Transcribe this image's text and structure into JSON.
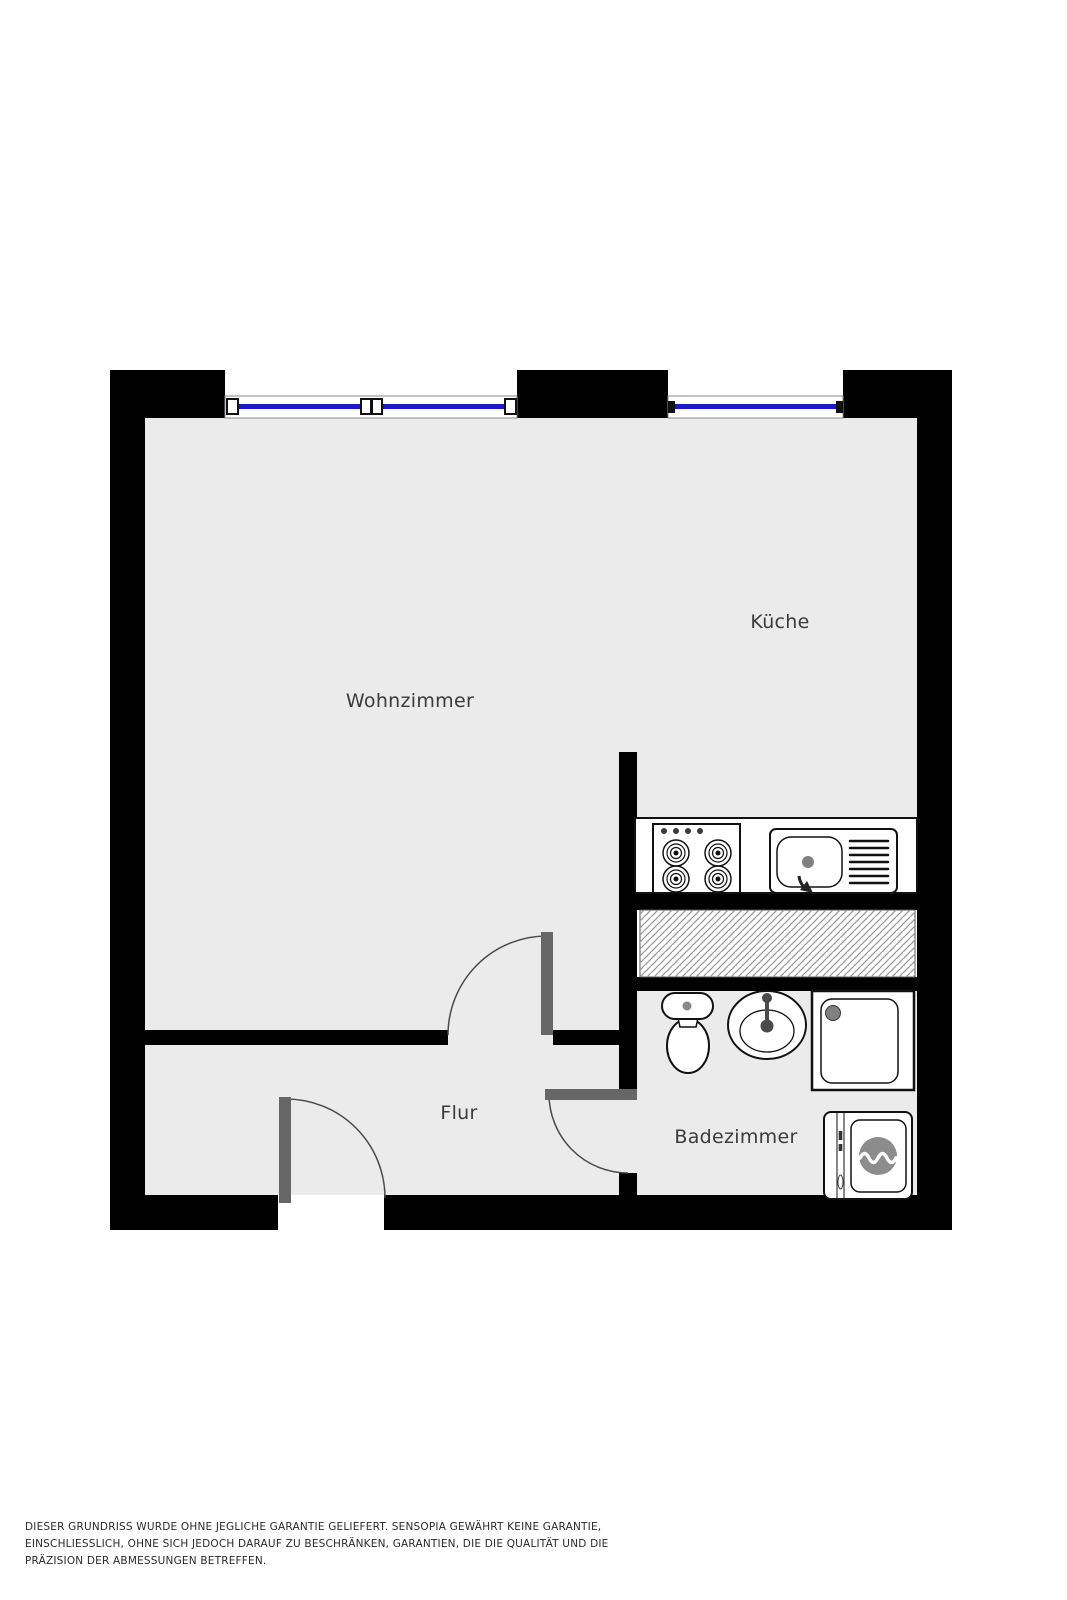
{
  "floorplan": {
    "rooms": {
      "wohnzimmer": {
        "label": "Wohnzimmer"
      },
      "kueche": {
        "label": "Küche"
      },
      "flur": {
        "label": "Flur"
      },
      "badezimmer": {
        "label": "Badezimmer"
      }
    },
    "fixtures": [
      "stove-icon",
      "kitchen-sink-icon",
      "duct-hatch-area",
      "toilet-icon",
      "washbasin-icon",
      "shower-icon",
      "washing-machine-icon"
    ],
    "windows": 2,
    "doors": 3,
    "colors": {
      "wall": "#000000",
      "floor": "#ebebeb",
      "window_glass": "#1a1acc",
      "door_leaf": "#666666",
      "hatch_line": "#9a9a9a",
      "label_text": "#3a3a3a"
    }
  },
  "disclaimer": {
    "lines": [
      "DIESER GRUNDRISS WURDE OHNE JEGLICHE GARANTIE GELIEFERT. SENSOPIA GEWÄHRT KEINE GARANTIE,",
      "EINSCHLIESSLICH, OHNE SICH JEDOCH DARAUF ZU BESCHRÄNKEN, GARANTIEN, DIE DIE QUALITÄT UND DIE",
      "PRÄZISION DER ABMESSUNGEN BETREFFEN."
    ]
  }
}
